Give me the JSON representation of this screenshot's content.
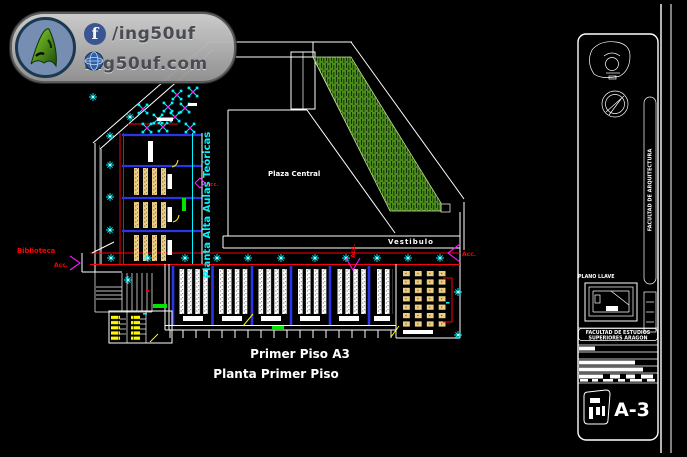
{
  "colors": {
    "bg": "#000000",
    "wall": "#ffffff",
    "cyan": "#00f6ff",
    "red": "#fb0006",
    "blue": "#2a35e8",
    "bright_green": "#00e400",
    "grass": "#4d8c1a",
    "grass_hatch": "#14320a",
    "desk_tan": "#eccd83",
    "yellow": "#fcf803",
    "magenta": "#f319f3",
    "facebook_blue": "#3b5998",
    "watermark_gray": "#b9bcc1",
    "watermark_text": "#4c4f55",
    "logo_blue": "#7a93b8",
    "logo_green": "#3f9b1c"
  },
  "watermark": {
    "facebook_handle": "/ing50uf",
    "website": "ing50uf.com"
  },
  "plan": {
    "room_labels": {
      "plaza": "Plaza Central",
      "vestibulo": "Vestibulo",
      "biblioteca": "Biblioteca",
      "aulas_wing": "Planta Alta Aulas Teóricas"
    },
    "access_labels": {
      "left": "Acc.",
      "middle": "Acc.",
      "right": "Acc.",
      "classroom": "Acc."
    },
    "caption": {
      "line1": "Primer Piso A3",
      "line2": "Planta Primer Piso"
    }
  },
  "titleblock": {
    "key_plan_label": "PLANO LLAVE",
    "project_line1": "FACULTAD DE ESTUDIOS",
    "project_line2": "SUPERIORES ARAGON",
    "side_text": "FACULTAD DE ARQUITECTURA",
    "sheet_number": "A-3"
  }
}
